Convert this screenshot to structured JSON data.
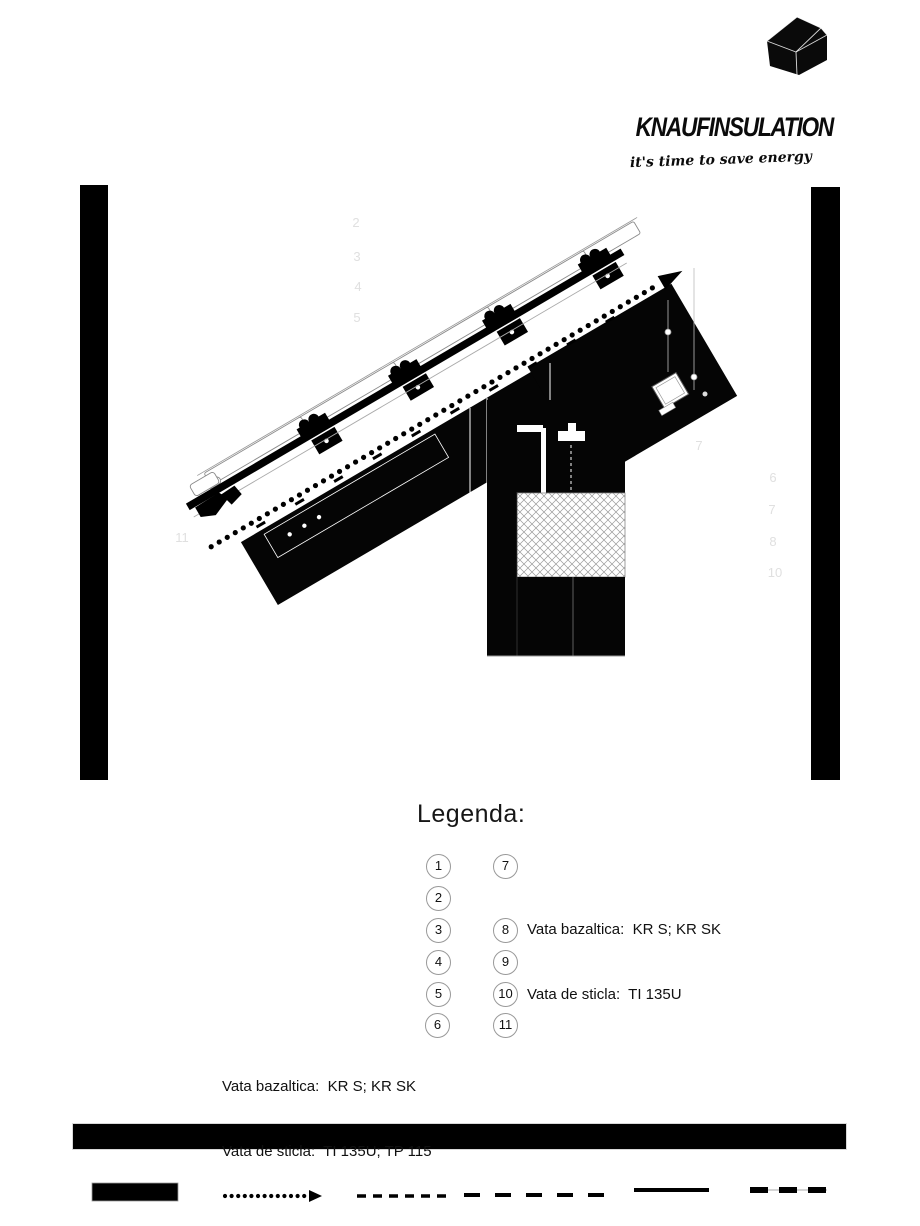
{
  "logo": {
    "brand": "knaufinsulation",
    "tagline": "it's time to save energy",
    "house_icon": "knauf-house-icon"
  },
  "legend": {
    "title": "Legenda:",
    "left_items": [
      "1",
      "2",
      "3",
      "4",
      "5",
      "6"
    ],
    "right_items": [
      "7",
      "8",
      "9",
      "10",
      "11"
    ],
    "note_right": {
      "line1": "Vata bazaltica:  KR S; KR SK",
      "line2": "Vata de sticla:  TI 135U"
    },
    "note_left": {
      "line1": "Vata bazaltica:  KR S; KR SK",
      "line2": "Vata de sticla:  TI 135U; TP 115"
    }
  },
  "drawing": {
    "description": "roof-eave-and-wall-detail-section",
    "callouts": [
      {
        "label": "2"
      },
      {
        "label": "3"
      },
      {
        "label": "4"
      },
      {
        "label": "5"
      },
      {
        "label": "11"
      },
      {
        "label": "7"
      },
      {
        "label": "6"
      },
      {
        "label": "7"
      },
      {
        "label": "8"
      },
      {
        "label": "10"
      }
    ],
    "colors": {
      "ink": "#000000",
      "paper": "#ffffff",
      "callout_gray": "#e0e0e0",
      "hairline_gray": "#999999"
    }
  },
  "line_samples": {
    "items": [
      "solid-fill-swatch",
      "dotted-arrow-line",
      "short-dash-line",
      "long-dash-line",
      "solid-line",
      "thick-dash-line"
    ]
  }
}
